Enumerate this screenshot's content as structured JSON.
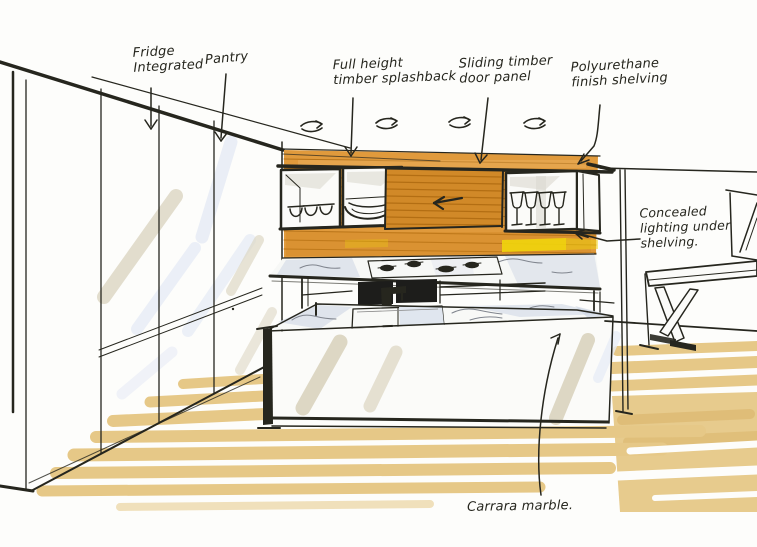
{
  "sketch": {
    "annotations": {
      "fridge": "Fridge\nIntegrated",
      "pantry": "Pantry",
      "splashback": "Full height\ntimber splashback",
      "slidingDoor": "Sliding timber\ndoor panel",
      "shelving": "Polyurethane\nfinish shelving",
      "lighting": "Concealed\nlighting under\nshelving.",
      "marble": "Carrara marble."
    },
    "materials": {
      "paper": "#FDFDFB",
      "ink": "#26261E",
      "timber": "#E09A3C",
      "timberDark": "#AE6A10",
      "timberDoor": "#D18928",
      "floor": "#E6C887",
      "floorDark": "#D9B368",
      "glow": "#F0D50C",
      "marbleShadow": "#DAE0EA",
      "highlight": "#DDD7C4",
      "highlightBlue": "#E9EDF6"
    }
  }
}
